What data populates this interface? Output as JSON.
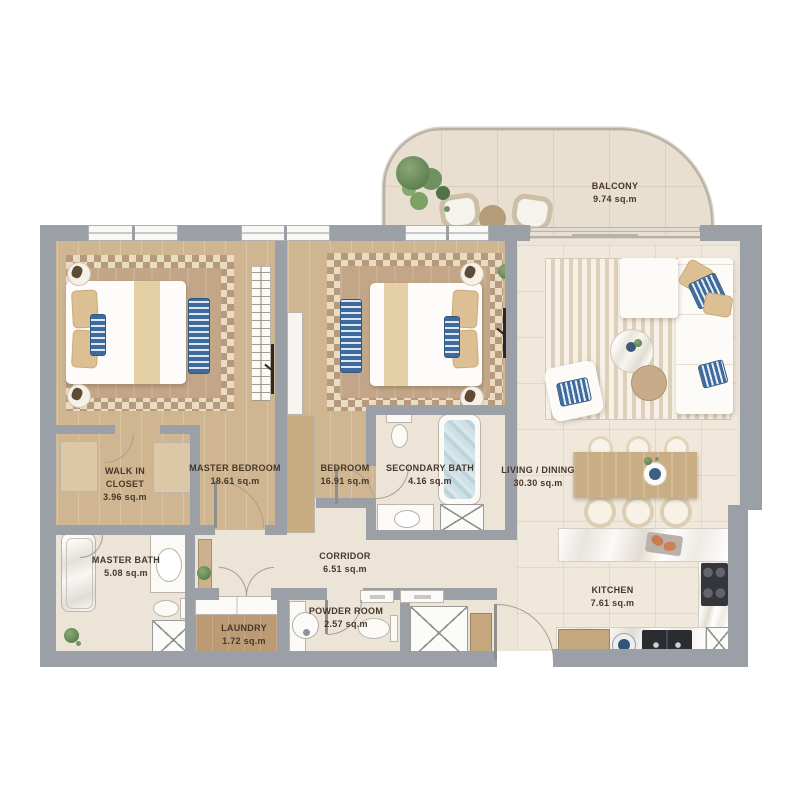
{
  "rooms": {
    "balcony": {
      "name": "BALCONY",
      "area": "9.74 sq.m"
    },
    "master_bedroom": {
      "name": "MASTER BEDROOM",
      "area": "18.61 sq.m"
    },
    "walk_in_closet": {
      "name": "WALK IN CLOSET",
      "area": "3.96 sq.m"
    },
    "bedroom": {
      "name": "BEDROOM",
      "area": "16.91 sq.m"
    },
    "secondary_bath": {
      "name": "SECONDARY BATH",
      "area": "4.16 sq.m"
    },
    "living_dining": {
      "name": "LIVING / DINING",
      "area": "30.30 sq.m"
    },
    "master_bath": {
      "name": "MASTER BATH",
      "area": "5.08 sq.m"
    },
    "corridor": {
      "name": "CORRIDOR",
      "area": "6.51 sq.m"
    },
    "laundry": {
      "name": "LAUNDRY",
      "area": "1.72 sq.m"
    },
    "powder_room": {
      "name": "POWDER ROOM",
      "area": "2.57 sq.m"
    },
    "kitchen": {
      "name": "KITCHEN",
      "area": "7.61 sq.m"
    }
  },
  "colors": {
    "wall": "#9aa0a6",
    "wood_floor": "#d0b591",
    "tile_floor": "#ece4d7",
    "rug": "#b79a7c",
    "accent_blue": "#3e6b9d",
    "label_text": "#46382a"
  }
}
